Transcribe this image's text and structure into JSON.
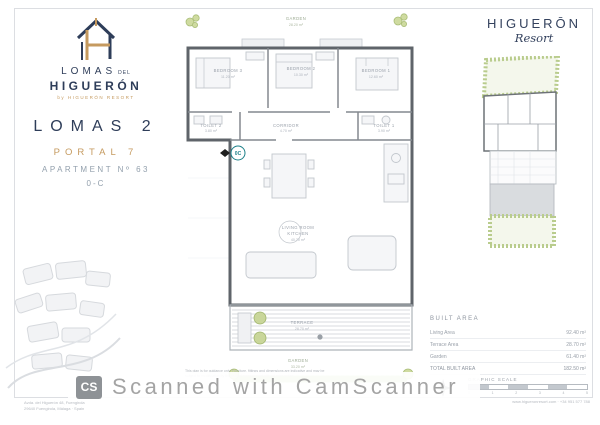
{
  "branding": {
    "logo_top": "LOMAS",
    "logo_top_small": "DEL",
    "logo_main": "HIGUERÓN",
    "byline": "by HIGUERÓN RESORT",
    "project": "LOMAS 2",
    "portal": "PORTAL 7",
    "apartment": "APARTMENT Nº 63",
    "unit": "0-C"
  },
  "resort": {
    "name": "HIGUERŌN",
    "sub": "Resort"
  },
  "floorplan": {
    "marker": "0C",
    "rooms": [
      {
        "label": "GARDEN",
        "area": "28.20 m²"
      },
      {
        "label": "BEDROOM 3",
        "area": "11.20 m²"
      },
      {
        "label": "BEDROOM 2",
        "area": "10.30 m²"
      },
      {
        "label": "BEDROOM 1",
        "area": "12.60 m²"
      },
      {
        "label": "TOILET 2",
        "area": "3.80 m²"
      },
      {
        "label": "CORRIDOR",
        "area": "4.70 m²"
      },
      {
        "label": "TOILET 1",
        "area": "3.90 m²"
      },
      {
        "label": "LIVING ROOM",
        "label2": "KITCHEN",
        "area": "40.70 m²"
      },
      {
        "label": "TERRACE",
        "area": "28.70 m²"
      },
      {
        "label": "GARDEN",
        "area": "33.20 m²"
      }
    ]
  },
  "table": {
    "header": "BUILT AREA",
    "rows": [
      {
        "label": "Living Area",
        "value": "92.40 m²"
      },
      {
        "label": "Terrace Area",
        "value": "28.70 m²"
      },
      {
        "label": "Garden",
        "value": "61.40 m²"
      },
      {
        "label": "TOTAL BUILT AREA",
        "value": "182.50 m²"
      }
    ]
  },
  "scale": {
    "label": "GRAPHIC SCALE",
    "ticks": [
      "0",
      "1",
      "2",
      "3",
      "4",
      "5"
    ]
  },
  "disclaimer": {
    "l1": "This plan is for guidance only. Furniture, fittings and dimensions are indicative and may be",
    "l2": "subject to modification by the project management without prior notice."
  },
  "footer": {
    "left1": "Avda. del Higuerón 48, Fuengirola",
    "left2": "29640 Fuengirola, Málaga · Spain",
    "right": "www.higueronresort.com · +34 951 577 788"
  },
  "watermark": {
    "badge": "CS",
    "text": "Scanned with CamScanner"
  },
  "colors": {
    "navy": "#2e3d59",
    "gold": "#c59a5f",
    "teal": "#1d8089",
    "wall": "#5f646a",
    "plant": "#bcd08f"
  }
}
